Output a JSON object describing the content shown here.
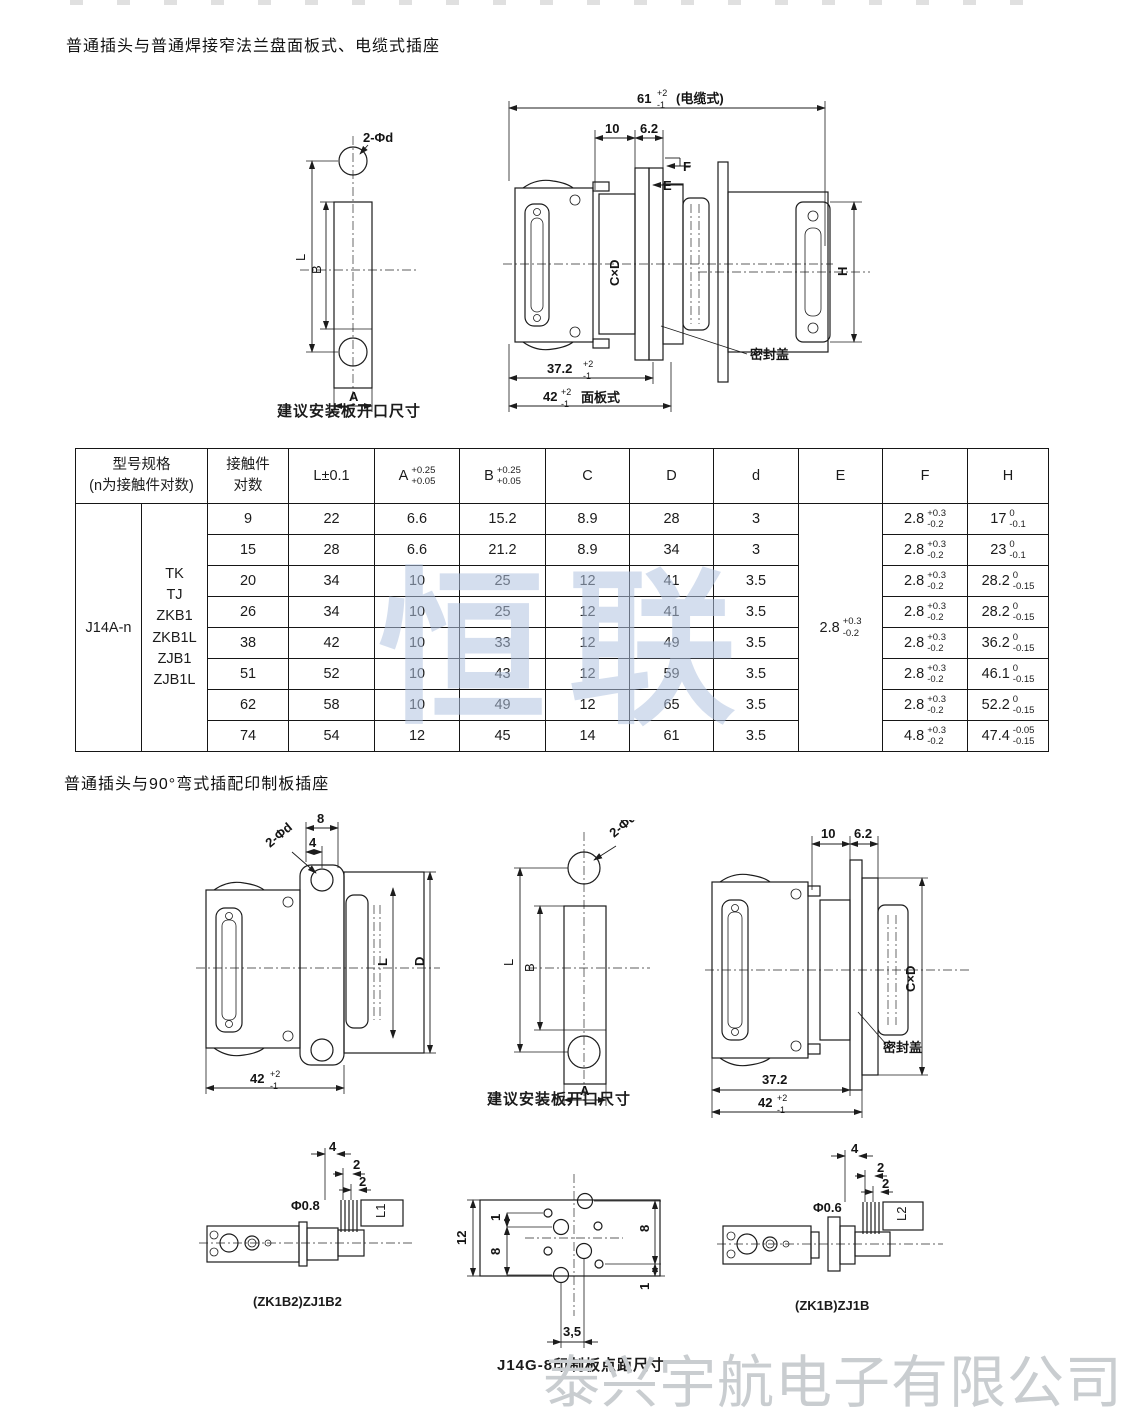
{
  "section1": {
    "title": "普通插头与普通焊接窄法兰盘面板式、电缆式插座",
    "plate_drawing": {
      "hole_label": "2-Φd",
      "dim_L": "L",
      "dim_B": "B",
      "dim_A": "A",
      "caption": "建议安装板开口尺寸"
    },
    "side_drawing": {
      "dim_61": "61",
      "dim_61_tol_up": "+2",
      "dim_61_tol_dn": "-1",
      "dim_61_note": "(电缆式)",
      "dim_10": "10",
      "dim_6_2": "6.2",
      "label_F": "F",
      "label_E": "E",
      "label_CxD": "C×D",
      "seal_label": "密封盖",
      "dim_37_2": "37.2",
      "dim_37_2_tol_up": "+2",
      "dim_37_2_tol_dn": "-1",
      "dim_42": "42",
      "dim_42_tol_up": "+2",
      "dim_42_tol_dn": "-1",
      "dim_42_note": "面板式"
    },
    "panel_drawing": {
      "dim_H": "H"
    }
  },
  "spec_table": {
    "col_model": "型号规格\n(n为接触件对数)",
    "col_contacts": "接触件\n对数",
    "col_L": "L±0.1",
    "col_A": "A",
    "col_A_tol_up": "+0.25",
    "col_A_tol_dn": "+0.05",
    "col_B": "B",
    "col_B_tol_up": "+0.25",
    "col_B_tol_dn": "+0.05",
    "col_C": "C",
    "col_D": "D",
    "col_d": "d",
    "col_E": "E",
    "col_F": "F",
    "col_H": "H",
    "model": "J14A-n",
    "types": "TK\nTJ\nZKB1\nZKB1L\nZJB1\nZJB1L",
    "E_val": "2.8",
    "E_tol_up": "+0.3",
    "E_tol_dn": "-0.2",
    "rows": [
      {
        "n": "9",
        "L": "22",
        "A": "6.6",
        "B": "15.2",
        "C": "8.9",
        "D": "28",
        "d": "3",
        "Fv": "2.8",
        "Fu": "+0.3",
        "Fd": "-0.2",
        "Hv": "17",
        "Hu": "0",
        "Hd": "-0.1"
      },
      {
        "n": "15",
        "L": "28",
        "A": "6.6",
        "B": "21.2",
        "C": "8.9",
        "D": "34",
        "d": "3",
        "Fv": "2.8",
        "Fu": "+0.3",
        "Fd": "-0.2",
        "Hv": "23",
        "Hu": "0",
        "Hd": "-0.1"
      },
      {
        "n": "20",
        "L": "34",
        "A": "10",
        "B": "25",
        "C": "12",
        "D": "41",
        "d": "3.5",
        "Fv": "2.8",
        "Fu": "+0.3",
        "Fd": "-0.2",
        "Hv": "28.2",
        "Hu": "0",
        "Hd": "-0.15"
      },
      {
        "n": "26",
        "L": "34",
        "A": "10",
        "B": "25",
        "C": "12",
        "D": "41",
        "d": "3.5",
        "Fv": "2.8",
        "Fu": "+0.3",
        "Fd": "-0.2",
        "Hv": "28.2",
        "Hu": "0",
        "Hd": "-0.15"
      },
      {
        "n": "38",
        "L": "42",
        "A": "10",
        "B": "33",
        "C": "12",
        "D": "49",
        "d": "3.5",
        "Fv": "2.8",
        "Fu": "+0.3",
        "Fd": "-0.2",
        "Hv": "36.2",
        "Hu": "0",
        "Hd": "-0.15"
      },
      {
        "n": "51",
        "L": "52",
        "A": "10",
        "B": "43",
        "C": "12",
        "D": "59",
        "d": "3.5",
        "Fv": "2.8",
        "Fu": "+0.3",
        "Fd": "-0.2",
        "Hv": "46.1",
        "Hu": "0",
        "Hd": "-0.15"
      },
      {
        "n": "62",
        "L": "58",
        "A": "10",
        "B": "49",
        "C": "12",
        "D": "65",
        "d": "3.5",
        "Fv": "2.8",
        "Fu": "+0.3",
        "Fd": "-0.2",
        "Hv": "52.2",
        "Hu": "0",
        "Hd": "-0.15"
      },
      {
        "n": "74",
        "L": "54",
        "A": "12",
        "B": "45",
        "C": "14",
        "D": "61",
        "d": "3.5",
        "Fv": "4.8",
        "Fu": "+0.3",
        "Fd": "-0.2",
        "Hv": "47.4",
        "Hu": "-0.05",
        "Hd": "-0.15"
      }
    ]
  },
  "section2": {
    "title": "普通插头与90°弯式插配印制板插座",
    "rear_drawing": {
      "dim_8": "8",
      "dim_4": "4",
      "hole_label": "2-Φd",
      "dim_L": "L",
      "dim_D": "D",
      "dim_42": "42",
      "dim_42_tol_up": "+2",
      "dim_42_tol_dn": "-1"
    },
    "plate_drawing": {
      "hole_label": "2-Φd",
      "dim_L": "L",
      "dim_B": "B",
      "dim_A": "A",
      "caption": "建议安装板开口尺寸"
    },
    "side_drawing": {
      "dim_10": "10",
      "dim_6_2": "6.2",
      "label_CxD": "C×D",
      "seal_label": "密封盖",
      "dim_37_2": "37.2",
      "dim_42": "42",
      "dim_42_tol_up": "+2",
      "dim_42_tol_dn": "-1"
    }
  },
  "bottom": {
    "left_drawing": {
      "dim_4": "4",
      "dim_2a": "2",
      "dim_2b": "2",
      "dia_label": "Φ0.8",
      "pin_label": "L1",
      "caption": "(ZK1B2)ZJ1B2"
    },
    "pcb_drawing": {
      "dim_12": "12",
      "dim_1a": "1",
      "dim_8a": "8",
      "dim_8b": "8",
      "dim_1b": "1",
      "dim_3_5": "3,5",
      "caption": "J14G-8印制板点距尺寸"
    },
    "right_drawing": {
      "dim_4": "4",
      "dim_2a": "2",
      "dim_2b": "2",
      "dia_label": "Φ0.6",
      "pin_label": "L2",
      "caption": "(ZK1B)ZJ1B"
    }
  },
  "watermarks": {
    "center": "恒联",
    "center_color": "rgba(177,194,224,0.55)",
    "bottom": "泰兴宇航电子有限公司",
    "bottom_color": "#c9cdd0"
  }
}
